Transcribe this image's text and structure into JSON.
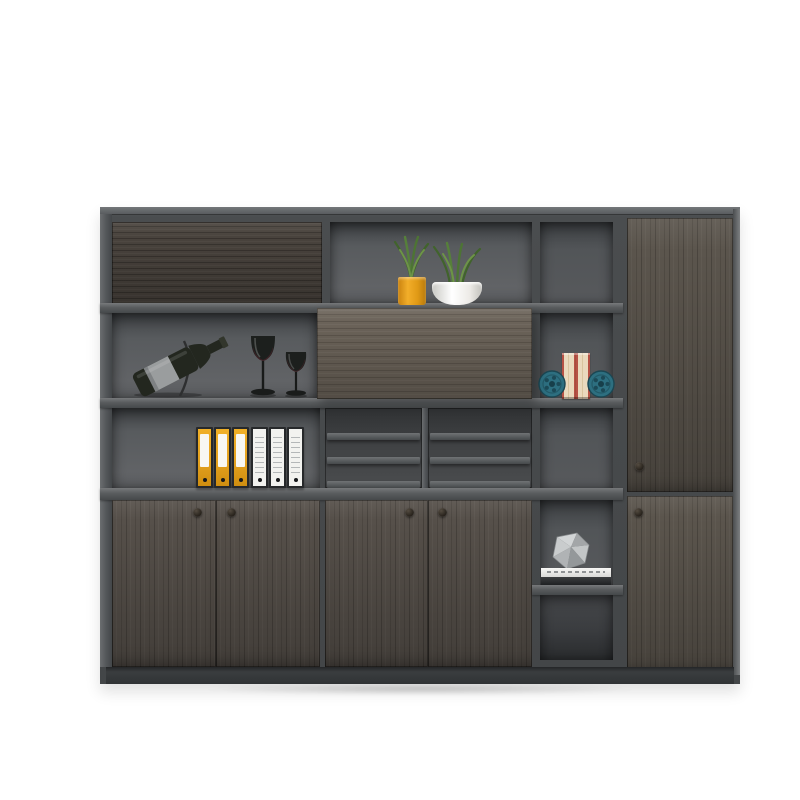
{
  "meta": {
    "type": "product-photo",
    "subject": "Modern dark grey wood office bookcase wall unit with open display shelves, sliding panel, file storage and tall side cabinet, staged with accessories",
    "background": "#ffffff"
  },
  "colors": {
    "background": "#ffffff",
    "frame": "#4a4d4f",
    "frame-light": "#6e7173",
    "interior": "#5c5e61",
    "interior-dark": "#3a3c3e",
    "wood-dark": "#49433d",
    "wood-mid": "#56504a",
    "wood-light": "#6b6359",
    "plinth": "#323437",
    "accent-yellow": "#e5a21f",
    "binder-white": "#f2f2ef",
    "plant-green": "#4d7434",
    "plant-green-light": "#6d9348",
    "pot-white": "#f6f6f3",
    "teal": "#2d6f80",
    "book-cream": "#ead9bd",
    "book-red": "#b65245",
    "glass-dark": "#1a1d1b",
    "bottle-body": "#23271f",
    "bottle-label": "#9a9d9e",
    "gem-gray": "#b7babc",
    "knob": "#241f19"
  },
  "structure": {
    "top_flap_door": "closed horizontal-grain wood flap door, upper left",
    "display_shelf": "open shelf with two potted grass plants",
    "wine_shelf": "open shelf with wine bottle on stand and two glasses",
    "sliding_panel": "light grey wood sliding door, middle row",
    "file_shelf": "open shelf holding six lever-arch binders",
    "magazine_rack": {
      "columns": 2,
      "slats_per_column": 3
    },
    "open_column_cells": 5,
    "lower_doors": {
      "count": 4,
      "knobs": 4
    },
    "tall_side_cabinet": {
      "doors": 2,
      "knobs": 2
    },
    "plinth": "recessed dark base"
  },
  "items": {
    "plant_small": {
      "label": "grass plant in yellow cylinder pot"
    },
    "plant_large": {
      "label": "grass plant in white bowl pot"
    },
    "wine_bottle": {
      "label": "dark wine bottle with grey label resting on wire stand"
    },
    "wine_glass_large": {
      "label": "tall dark wine glass"
    },
    "wine_glass_small": {
      "label": "short dark wine glass"
    },
    "binders_yellow": {
      "label": "yellow lever-arch binders",
      "count": 3
    },
    "binders_white": {
      "label": "white lever-arch binders",
      "count": 3
    },
    "books_upright": {
      "label": "two cream-and-red books between bookends",
      "count": 2
    },
    "reel_bookends": {
      "label": "teal film-reel bookends",
      "count": 2
    },
    "gem_decor": {
      "label": "faceted grey stone ornament"
    },
    "book_stack": {
      "label": "white and dark books stacked under ornament"
    }
  }
}
